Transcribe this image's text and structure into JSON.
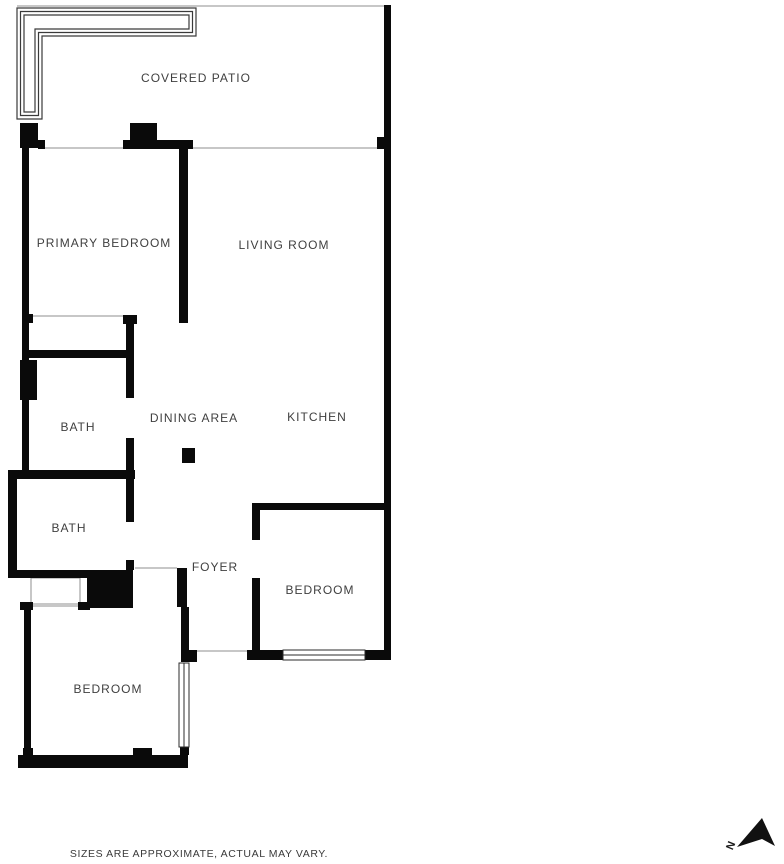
{
  "floor_plan": {
    "rooms": {
      "covered_patio": "COVERED PATIO",
      "primary_bedroom": "PRIMARY BEDROOM",
      "living_room": "LIVING ROOM",
      "dining_area": "DINING AREA",
      "kitchen": "KITCHEN",
      "bath_upper": "BATH",
      "bath_lower": "BATH",
      "foyer": "FOYER",
      "bedroom_right": "BEDROOM",
      "bedroom_lower": "BEDROOM"
    },
    "compass": {
      "letter": "N"
    },
    "disclaimer": "SIZES ARE APPROXIMATE, ACTUAL MAY VARY.",
    "colors": {
      "wall": "#0a0a0a",
      "label_text": "#3f3f3f",
      "thin_line": "#8f8f8f",
      "background": "#ffffff"
    }
  }
}
